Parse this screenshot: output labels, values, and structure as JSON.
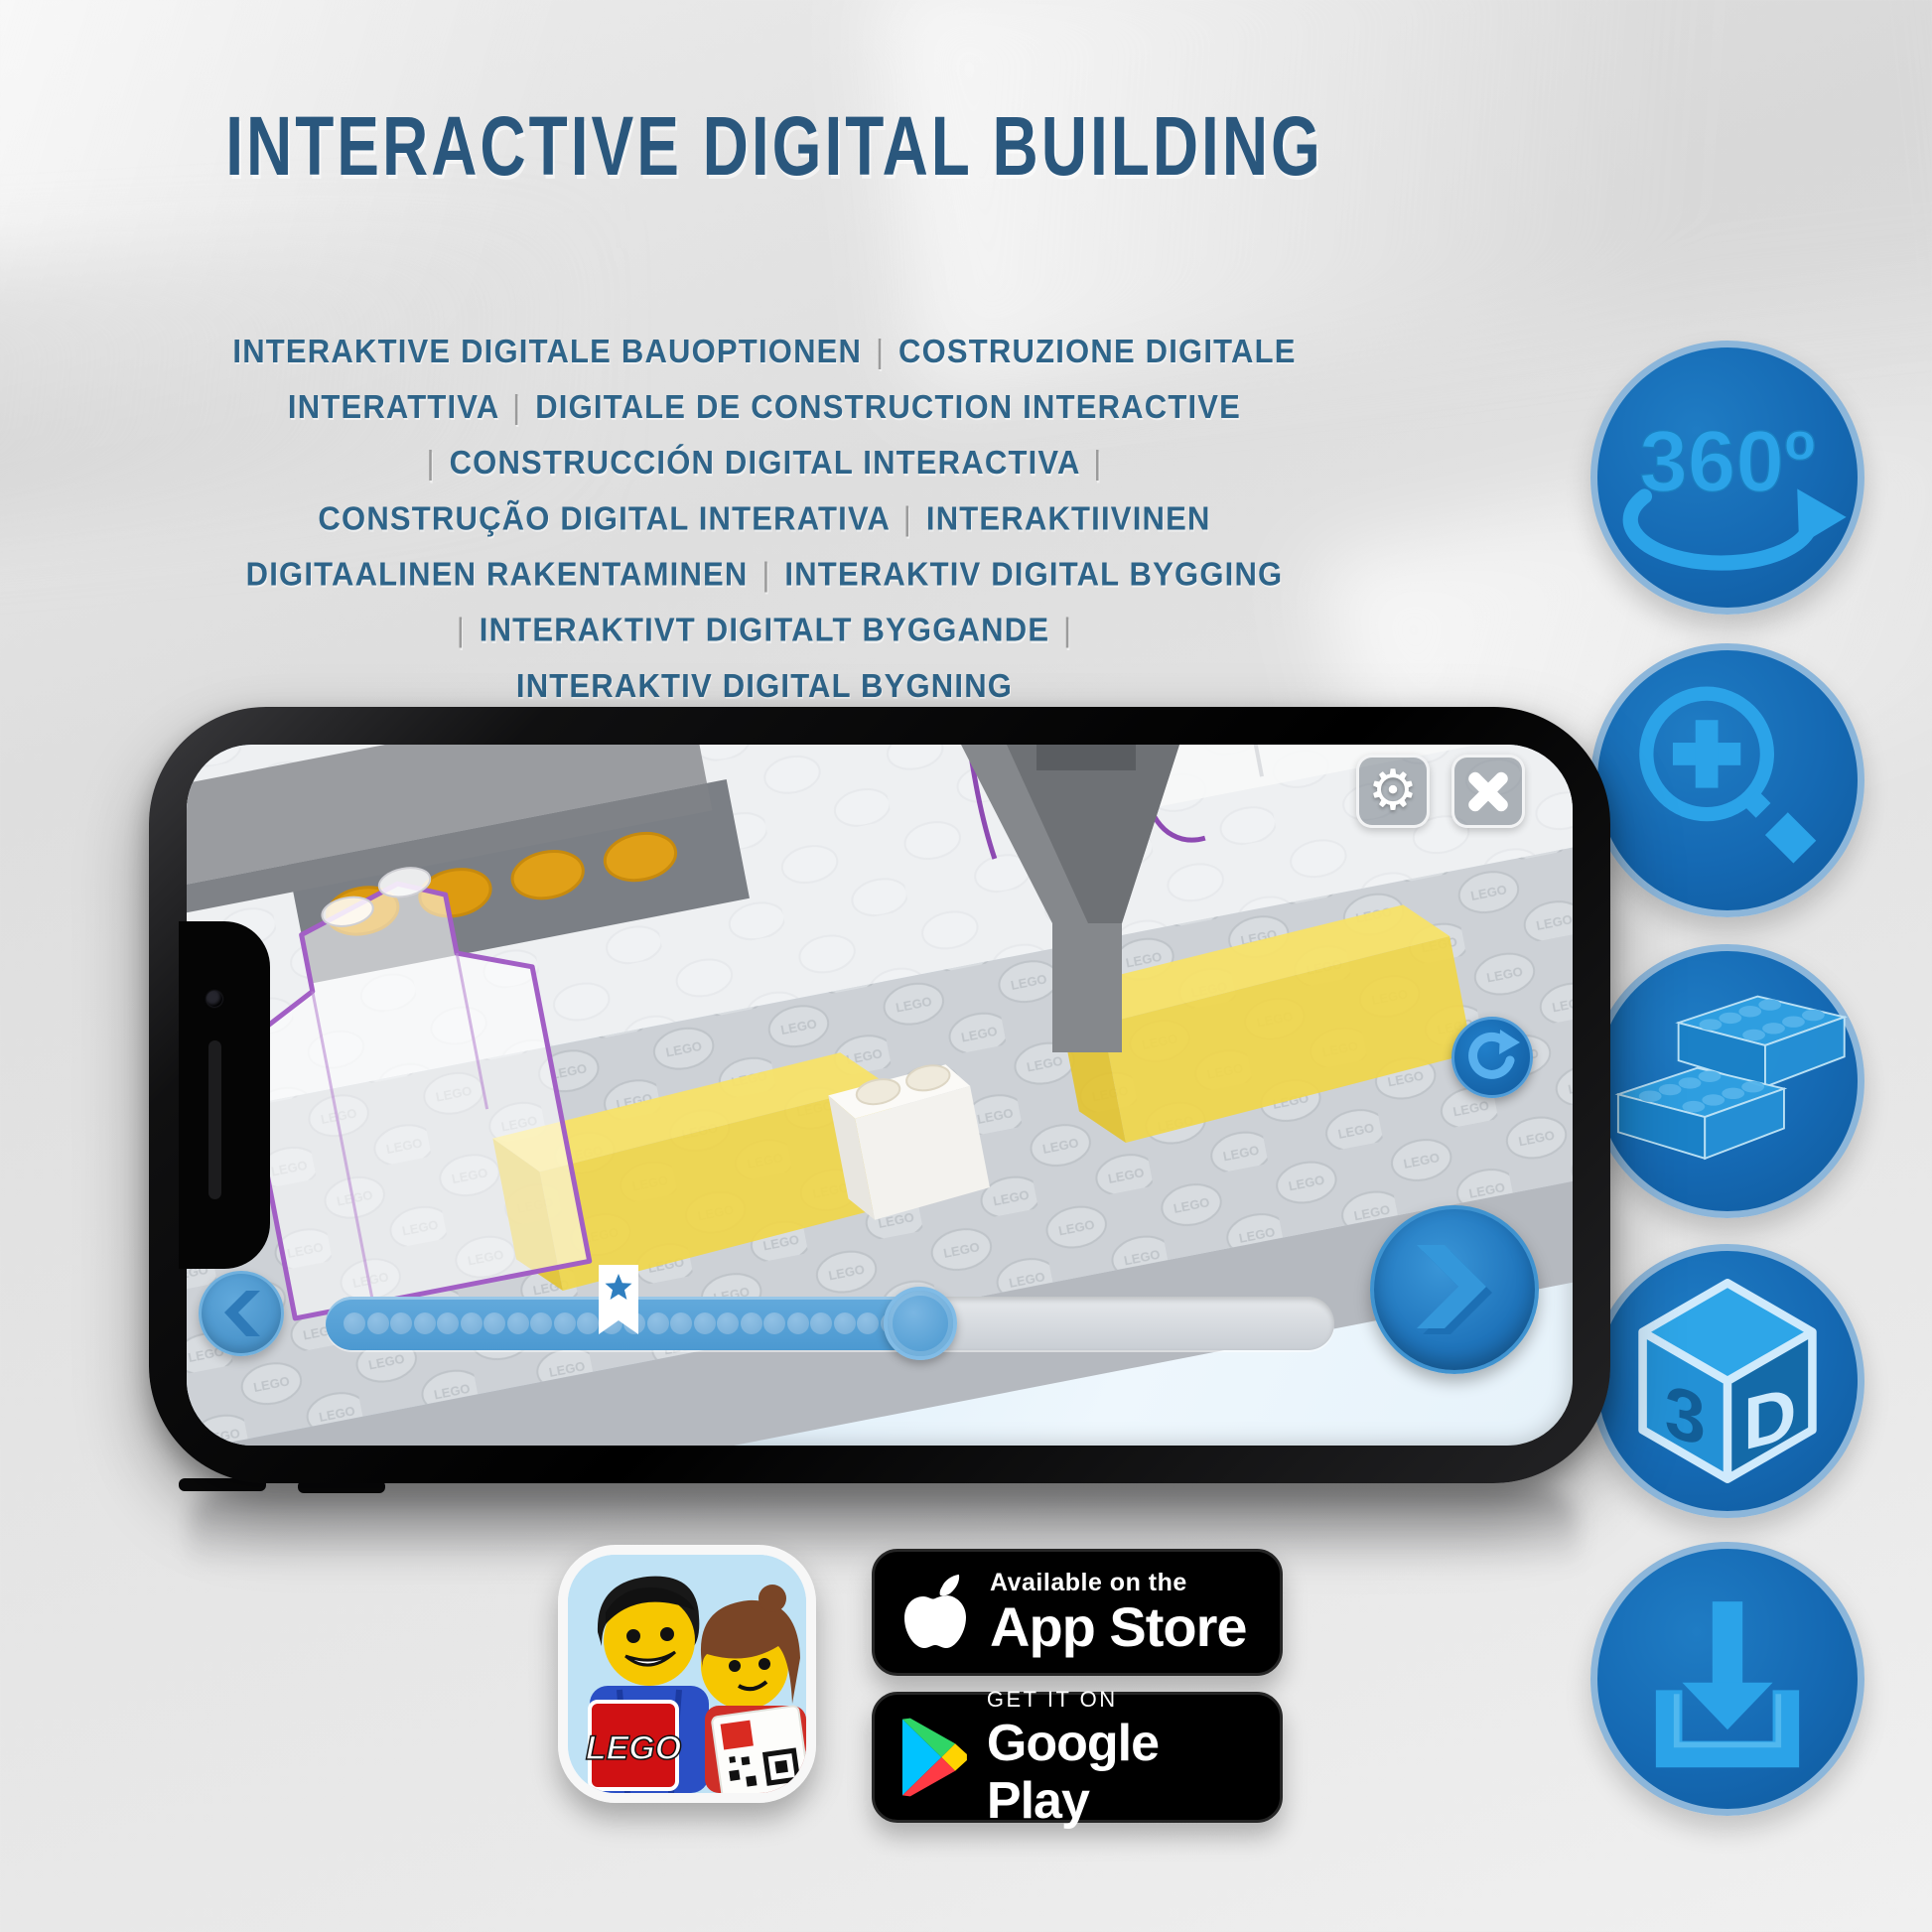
{
  "title": {
    "text": "INTERACTIVE DIGITAL BUILDING"
  },
  "subtitle": {
    "lines": [
      "INTERAKTIVE DIGITALE BAUOPTIONEN | COSTRUZIONE DIGITALE",
      "INTERATTIVA | DIGITALE DE CONSTRUCTION INTERACTIVE",
      "| CONSTRUCCIÓN DIGITAL INTERACTIVA |",
      "CONSTRUÇÃO DIGITAL INTERATIVA | INTERAKTIIVINEN",
      "DIGITAALINEN RAKENTAMINEN | INTERAKTIV DIGITAL BYGGING",
      "| INTERAKTIVT DIGITALT BYGGANDE |",
      "INTERAKTIV DIGITAL BYGNING"
    ]
  },
  "colors": {
    "title": "#2a577d",
    "subtitle": "#2e6489",
    "separator": "#9b9b9b",
    "accent": "#1569b3",
    "circleborder": "#8cb6da",
    "glyph": "#2ba3e8",
    "progress": "#55a1d5",
    "yellow": "#f1d647",
    "purple": "#a25fc5"
  },
  "feature_icons": {
    "items": [
      {
        "name": "360-rotation",
        "label": "360º"
      },
      {
        "name": "zoom-in",
        "label": ""
      },
      {
        "name": "building-bricks",
        "label": ""
      },
      {
        "name": "3d-view",
        "digit": "3",
        "letter": "D"
      },
      {
        "name": "download",
        "label": ""
      }
    ]
  },
  "phone": {
    "scene": {
      "stud_embossing": "LEGO"
    },
    "progress": {
      "dot_count": 24,
      "filled_percent": 59,
      "bookmark_percent": 29
    }
  },
  "badges": {
    "app_store": {
      "tagline": "Available on the",
      "store": "App Store"
    },
    "google_play": {
      "tagline": "GET IT ON",
      "store": "Google Play"
    }
  },
  "app_icon": {
    "logo": "LEGO"
  }
}
